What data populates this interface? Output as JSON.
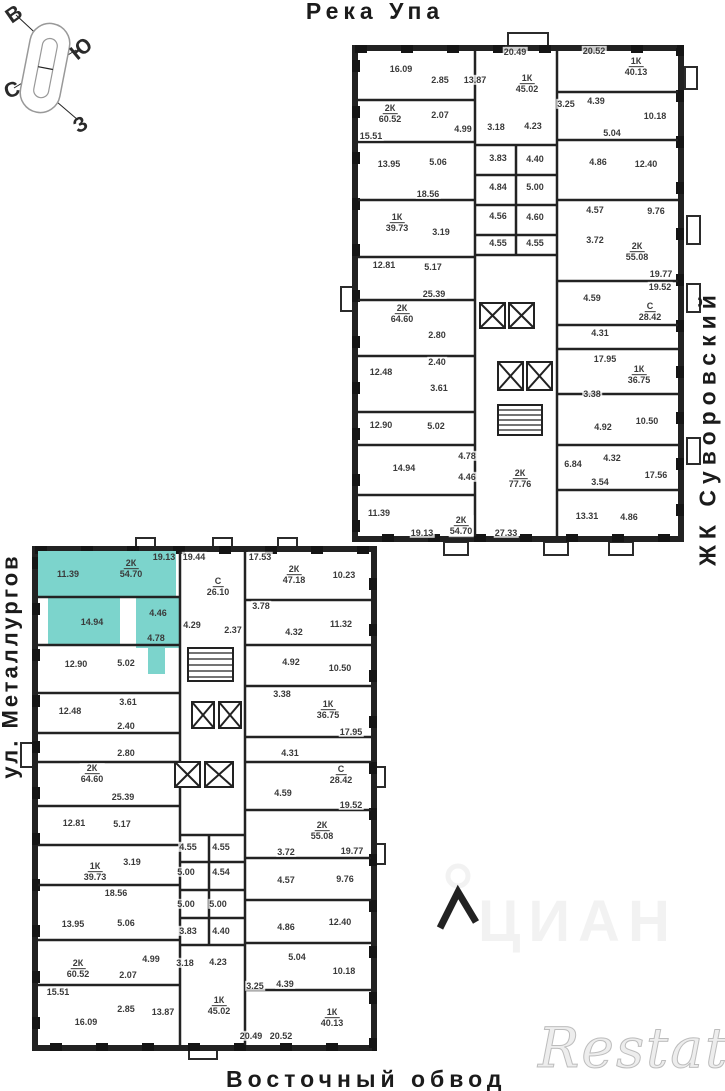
{
  "page": {
    "width": 725,
    "height": 1091
  },
  "colors": {
    "wall": "#222222",
    "highlight": "#7cd4cc",
    "ink": "#3a3a3a"
  },
  "compass": {
    "east": "В",
    "south": "Ю",
    "north": "С",
    "west": "З"
  },
  "street_labels": {
    "top": "Река Упа",
    "right": "ЖК Суворовский",
    "left": "ул. Металлургов",
    "bottom": "Восточный обвод"
  },
  "watermarks": {
    "cian": "ЦИАН",
    "restate": "Restate"
  },
  "highlighted_apartment": {
    "type": "2К",
    "area": "54.70",
    "building": "bottom"
  },
  "buildings": {
    "top": {
      "rooms": [
        {
          "t": "16.09",
          "x": 401,
          "y": 69
        },
        {
          "t": "2.85",
          "x": 440,
          "y": 80
        },
        {
          "t": "13.87",
          "x": 475,
          "y": 80
        },
        {
          "t": "20.49",
          "x": 515,
          "y": 52
        },
        {
          "t": "20.52",
          "x": 594,
          "y": 51
        },
        {
          "t": "3.25",
          "x": 566,
          "y": 104
        },
        {
          "t": "4.39",
          "x": 596,
          "y": 101
        },
        {
          "t": "10.18",
          "x": 655,
          "y": 116
        },
        {
          "t": "2.07",
          "x": 440,
          "y": 115
        },
        {
          "t": "4.99",
          "x": 463,
          "y": 129
        },
        {
          "t": "3.18",
          "x": 496,
          "y": 127
        },
        {
          "t": "4.23",
          "x": 533,
          "y": 126
        },
        {
          "t": "5.04",
          "x": 612,
          "y": 133
        },
        {
          "t": "15.51",
          "x": 371,
          "y": 136
        },
        {
          "t": "13.95",
          "x": 389,
          "y": 164
        },
        {
          "t": "5.06",
          "x": 438,
          "y": 162
        },
        {
          "t": "3.83",
          "x": 498,
          "y": 158
        },
        {
          "t": "4.40",
          "x": 535,
          "y": 159
        },
        {
          "t": "4.86",
          "x": 598,
          "y": 162
        },
        {
          "t": "12.40",
          "x": 646,
          "y": 164
        },
        {
          "t": "18.56",
          "x": 428,
          "y": 194
        },
        {
          "t": "4.84",
          "x": 498,
          "y": 187
        },
        {
          "t": "5.00",
          "x": 535,
          "y": 187
        },
        {
          "t": "4.56",
          "x": 498,
          "y": 216
        },
        {
          "t": "4.60",
          "x": 535,
          "y": 217
        },
        {
          "t": "4.57",
          "x": 595,
          "y": 210
        },
        {
          "t": "9.76",
          "x": 656,
          "y": 211
        },
        {
          "t": "3.19",
          "x": 441,
          "y": 232
        },
        {
          "t": "4.55",
          "x": 498,
          "y": 243
        },
        {
          "t": "4.55",
          "x": 535,
          "y": 243
        },
        {
          "t": "3.72",
          "x": 595,
          "y": 240
        },
        {
          "t": "12.81",
          "x": 384,
          "y": 265
        },
        {
          "t": "5.17",
          "x": 433,
          "y": 267
        },
        {
          "t": "19.77",
          "x": 661,
          "y": 274
        },
        {
          "t": "19.52",
          "x": 660,
          "y": 287
        },
        {
          "t": "25.39",
          "x": 434,
          "y": 294
        },
        {
          "t": "4.59",
          "x": 592,
          "y": 298
        },
        {
          "t": "2.80",
          "x": 437,
          "y": 335
        },
        {
          "t": "4.31",
          "x": 600,
          "y": 333
        },
        {
          "t": "17.95",
          "x": 605,
          "y": 359
        },
        {
          "t": "2.40",
          "x": 437,
          "y": 362
        },
        {
          "t": "12.48",
          "x": 381,
          "y": 372
        },
        {
          "t": "3.61",
          "x": 439,
          "y": 388
        },
        {
          "t": "3.38",
          "x": 592,
          "y": 394
        },
        {
          "t": "12.90",
          "x": 381,
          "y": 425
        },
        {
          "t": "5.02",
          "x": 436,
          "y": 426
        },
        {
          "t": "4.92",
          "x": 603,
          "y": 427
        },
        {
          "t": "10.50",
          "x": 647,
          "y": 421
        },
        {
          "t": "14.94",
          "x": 404,
          "y": 468
        },
        {
          "t": "4.78",
          "x": 467,
          "y": 456
        },
        {
          "t": "4.46",
          "x": 467,
          "y": 477
        },
        {
          "t": "6.84",
          "x": 573,
          "y": 464
        },
        {
          "t": "4.32",
          "x": 612,
          "y": 458
        },
        {
          "t": "3.54",
          "x": 600,
          "y": 482
        },
        {
          "t": "17.56",
          "x": 656,
          "y": 475
        },
        {
          "t": "11.39",
          "x": 379,
          "y": 513
        },
        {
          "t": "19.13",
          "x": 422,
          "y": 533
        },
        {
          "t": "27.33",
          "x": 506,
          "y": 533
        },
        {
          "t": "13.31",
          "x": 587,
          "y": 516
        },
        {
          "t": "4.86",
          "x": 629,
          "y": 517
        }
      ],
      "apartments": [
        {
          "k": "1К",
          "a": "45.02",
          "x": 527,
          "y": 84
        },
        {
          "k": "1К",
          "a": "40.13",
          "x": 636,
          "y": 67
        },
        {
          "k": "2К",
          "a": "60.52",
          "x": 390,
          "y": 114
        },
        {
          "k": "1К",
          "a": "39.73",
          "x": 397,
          "y": 223
        },
        {
          "k": "2К",
          "a": "55.08",
          "x": 637,
          "y": 252
        },
        {
          "k": "С",
          "a": "28.42",
          "x": 650,
          "y": 312
        },
        {
          "k": "2К",
          "a": "64.60",
          "x": 402,
          "y": 314
        },
        {
          "k": "1К",
          "a": "36.75",
          "x": 639,
          "y": 375
        },
        {
          "k": "2К",
          "a": "77.76",
          "x": 520,
          "y": 479
        },
        {
          "k": "2К",
          "a": "54.70",
          "x": 461,
          "y": 526
        }
      ]
    },
    "bottom": {
      "rooms": [
        {
          "t": "19.13",
          "x": 164,
          "y": 557,
          "hl": true
        },
        {
          "t": "19.44",
          "x": 194,
          "y": 557
        },
        {
          "t": "17.53",
          "x": 260,
          "y": 557
        },
        {
          "t": "11.39",
          "x": 68,
          "y": 574,
          "hl": true
        },
        {
          "t": "10.23",
          "x": 344,
          "y": 575
        },
        {
          "t": "3.78",
          "x": 261,
          "y": 606
        },
        {
          "t": "4.46",
          "x": 158,
          "y": 613,
          "hl": true
        },
        {
          "t": "14.94",
          "x": 92,
          "y": 622,
          "hl": true
        },
        {
          "t": "4.29",
          "x": 192,
          "y": 625
        },
        {
          "t": "2.37",
          "x": 233,
          "y": 630
        },
        {
          "t": "4.32",
          "x": 294,
          "y": 632
        },
        {
          "t": "11.32",
          "x": 341,
          "y": 624
        },
        {
          "t": "4.78",
          "x": 156,
          "y": 638,
          "hl": true
        },
        {
          "t": "12.90",
          "x": 76,
          "y": 664
        },
        {
          "t": "5.02",
          "x": 126,
          "y": 663
        },
        {
          "t": "4.92",
          "x": 291,
          "y": 662
        },
        {
          "t": "10.50",
          "x": 340,
          "y": 668
        },
        {
          "t": "3.38",
          "x": 282,
          "y": 694
        },
        {
          "t": "3.61",
          "x": 128,
          "y": 702
        },
        {
          "t": "12.48",
          "x": 70,
          "y": 711
        },
        {
          "t": "2.40",
          "x": 126,
          "y": 726
        },
        {
          "t": "17.95",
          "x": 351,
          "y": 732
        },
        {
          "t": "2.80",
          "x": 126,
          "y": 753
        },
        {
          "t": "4.31",
          "x": 290,
          "y": 753
        },
        {
          "t": "4.59",
          "x": 283,
          "y": 793
        },
        {
          "t": "25.39",
          "x": 123,
          "y": 797
        },
        {
          "t": "19.52",
          "x": 351,
          "y": 805
        },
        {
          "t": "12.81",
          "x": 74,
          "y": 823
        },
        {
          "t": "5.17",
          "x": 122,
          "y": 824
        },
        {
          "t": "3.72",
          "x": 286,
          "y": 852
        },
        {
          "t": "19.77",
          "x": 352,
          "y": 851
        },
        {
          "t": "3.19",
          "x": 132,
          "y": 862
        },
        {
          "t": "4.55",
          "x": 188,
          "y": 847
        },
        {
          "t": "4.55",
          "x": 221,
          "y": 847
        },
        {
          "t": "5.00",
          "x": 186,
          "y": 872
        },
        {
          "t": "4.54",
          "x": 221,
          "y": 872
        },
        {
          "t": "4.57",
          "x": 286,
          "y": 880
        },
        {
          "t": "9.76",
          "x": 345,
          "y": 879
        },
        {
          "t": "18.56",
          "x": 116,
          "y": 893
        },
        {
          "t": "5.00",
          "x": 186,
          "y": 904
        },
        {
          "t": "5.00",
          "x": 218,
          "y": 904
        },
        {
          "t": "13.95",
          "x": 73,
          "y": 924
        },
        {
          "t": "5.06",
          "x": 126,
          "y": 923
        },
        {
          "t": "3.83",
          "x": 188,
          "y": 931
        },
        {
          "t": "4.40",
          "x": 221,
          "y": 931
        },
        {
          "t": "4.86",
          "x": 286,
          "y": 927
        },
        {
          "t": "12.40",
          "x": 340,
          "y": 922
        },
        {
          "t": "4.99",
          "x": 151,
          "y": 959
        },
        {
          "t": "3.18",
          "x": 185,
          "y": 963
        },
        {
          "t": "4.23",
          "x": 218,
          "y": 962
        },
        {
          "t": "5.04",
          "x": 297,
          "y": 957
        },
        {
          "t": "2.07",
          "x": 128,
          "y": 975
        },
        {
          "t": "3.25",
          "x": 255,
          "y": 986
        },
        {
          "t": "4.39",
          "x": 285,
          "y": 984
        },
        {
          "t": "10.18",
          "x": 344,
          "y": 971
        },
        {
          "t": "15.51",
          "x": 58,
          "y": 992
        },
        {
          "t": "2.85",
          "x": 126,
          "y": 1009
        },
        {
          "t": "16.09",
          "x": 86,
          "y": 1022
        },
        {
          "t": "13.87",
          "x": 163,
          "y": 1012
        },
        {
          "t": "20.49",
          "x": 251,
          "y": 1036
        },
        {
          "t": "20.52",
          "x": 281,
          "y": 1036
        }
      ],
      "apartments": [
        {
          "k": "2К",
          "a": "54.70",
          "x": 131,
          "y": 569,
          "hl": true
        },
        {
          "k": "2К",
          "a": "47.18",
          "x": 294,
          "y": 575
        },
        {
          "k": "С",
          "a": "26.10",
          "x": 218,
          "y": 587
        },
        {
          "k": "1К",
          "a": "36.75",
          "x": 328,
          "y": 710
        },
        {
          "k": "2К",
          "a": "64.60",
          "x": 92,
          "y": 774
        },
        {
          "k": "С",
          "a": "28.42",
          "x": 341,
          "y": 775
        },
        {
          "k": "2К",
          "a": "55.08",
          "x": 322,
          "y": 831
        },
        {
          "k": "1К",
          "a": "39.73",
          "x": 95,
          "y": 872
        },
        {
          "k": "2К",
          "a": "60.52",
          "x": 78,
          "y": 969
        },
        {
          "k": "1К",
          "a": "45.02",
          "x": 219,
          "y": 1006
        },
        {
          "k": "1К",
          "a": "40.13",
          "x": 332,
          "y": 1018
        }
      ]
    }
  }
}
